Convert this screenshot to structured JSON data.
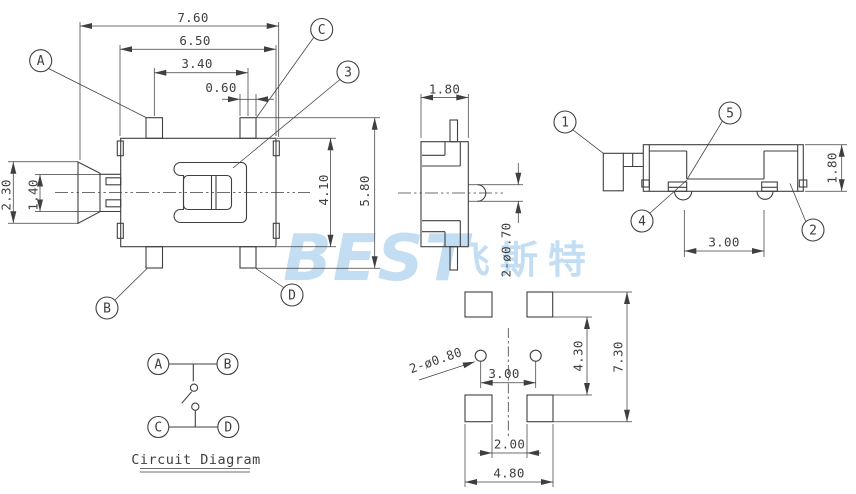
{
  "colors": {
    "line": "#3f3f3f",
    "watermark": "#b9d9f1",
    "background": "#ffffff"
  },
  "watermark": {
    "latin": "BEST",
    "cjk": "飞斯特"
  },
  "main_view": {
    "dim_width_total": "7.60",
    "dim_width_body": "6.50",
    "dim_tab_span": "3.40",
    "dim_tab_width": "0.60",
    "dim_lever_height": "2.30",
    "dim_shaft_height": "1.40",
    "dim_body_height": "4.10",
    "dim_overall_height": "5.80",
    "balloon_a": "A",
    "balloon_b": "B",
    "balloon_c": "C",
    "balloon_d": "D",
    "balloon_3": "3"
  },
  "side_view": {
    "dim_thickness": "1.80",
    "dim_pin_dia": "2-ø0.70"
  },
  "end_view": {
    "dim_height": "1.80",
    "dim_pin_pitch": "3.00",
    "balloon_1": "1",
    "balloon_2": "2",
    "balloon_4": "4",
    "balloon_5": "5"
  },
  "footprint_view": {
    "dim_hole_dia": "2-ø0.80",
    "dim_hole_pitch": "3.00",
    "dim_pad_inner_v": "4.30",
    "dim_pad_outer_v": "7.30",
    "dim_pad_inner_h": "2.00",
    "dim_pad_outer_h": "4.80"
  },
  "circuit_diagram": {
    "terminal_a": "A",
    "terminal_b": "B",
    "terminal_c": "C",
    "terminal_d": "D",
    "title": "Circuit Diagram"
  }
}
